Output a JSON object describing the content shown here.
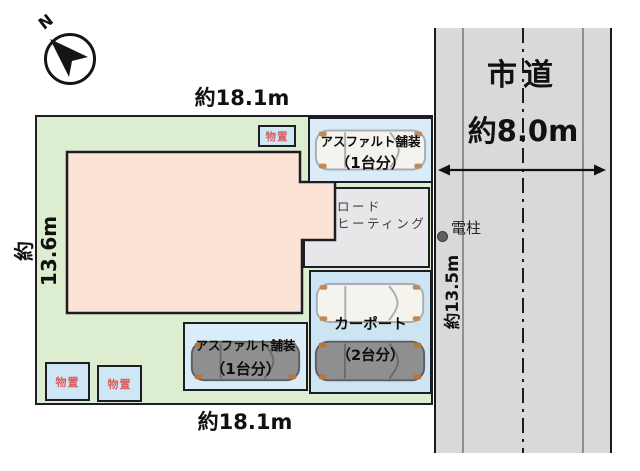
{
  "compass": {
    "north_label": "N"
  },
  "dimensions": {
    "top_width": "約18.1m",
    "bottom_width": "約18.1m",
    "left_depth": "約13.6m",
    "right_depth": "約13.5m"
  },
  "road": {
    "name": "市道",
    "width_label": "約8.0m"
  },
  "utility_pole": {
    "label": "電柱"
  },
  "storage": {
    "top": "物置",
    "bottom_left": "物置",
    "bottom_mid": "物置"
  },
  "areas": {
    "asphalt_top": {
      "line1": "アスファルト舗装",
      "line2": "（1台分）"
    },
    "asphalt_bottom": {
      "line1": "アスファルト舗装",
      "line2": "（1台分）"
    },
    "road_heating": {
      "line1": "ロード",
      "line2": "ヒーティング"
    },
    "carport": {
      "line1": "カーポート",
      "line2": "（2台分）"
    }
  },
  "colors": {
    "lot_green": "#dcedd0",
    "building_pink": "#fbe4d5",
    "parking_blue": "#d9ecf8",
    "carport_blue": "#cde4f2",
    "storage_blue": "#cfe7f5",
    "road_gray": "#d9d9d9",
    "heating_gray": "#e7e7ea",
    "border_dark": "#1d1d28",
    "storage_text_red": "#d95f5f"
  }
}
